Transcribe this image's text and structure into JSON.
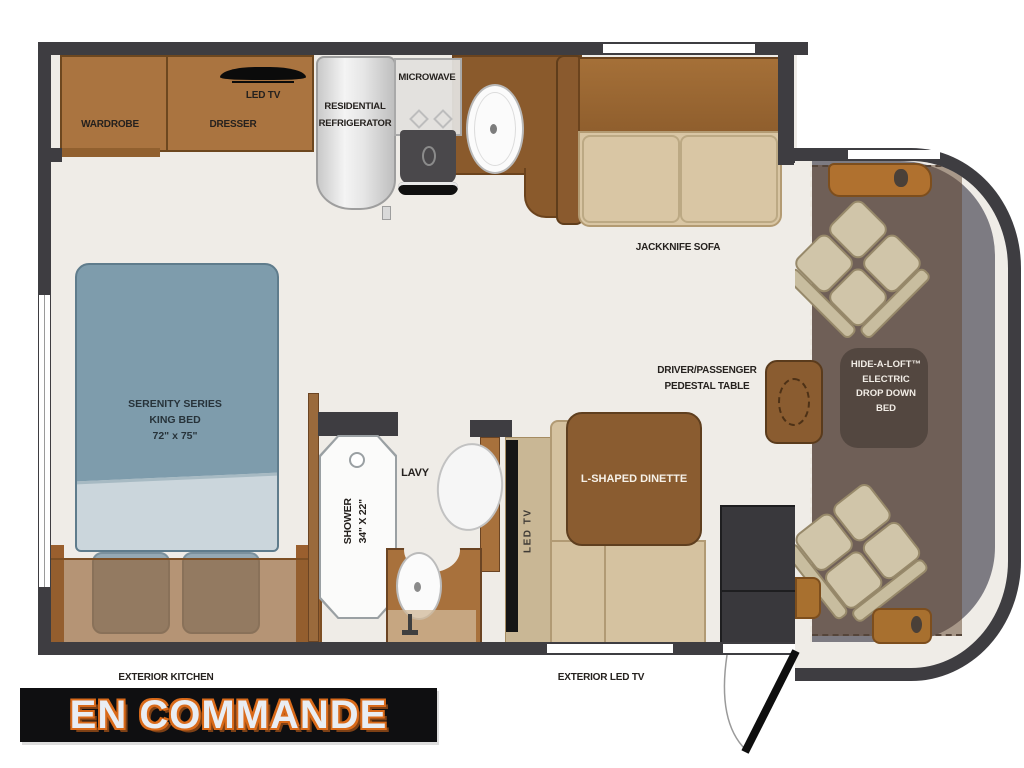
{
  "title_banner": {
    "text": "EN COMMANDE",
    "bg": "#0f0f11",
    "fg": "#e9edf3",
    "outline": "#d96a1a"
  },
  "rooms": {
    "bedroom": {
      "wardrobe_label": "WARDROBE",
      "dresser_label": "DRESSER",
      "tv_label": "LED TV",
      "bed_label_1": "SERENITY SERIES",
      "bed_label_2": "KING BED",
      "bed_label_3": "72\" x 75\""
    },
    "kitchen": {
      "fridge_label_1": "RESIDENTIAL",
      "fridge_label_2": "REFRIGERATOR",
      "microwave_label": "MICROWAVE"
    },
    "living_area": {
      "sofa_label": "JACKKNIFE SOFA",
      "dinette_label": "L-SHAPED DINETTE",
      "dinette_tv_label": "LED TV",
      "pedestal_label_1": "DRIVER/PASSENGER",
      "pedestal_label_2": "PEDESTAL TABLE"
    },
    "bathroom": {
      "shower_label_1": "SHOWER",
      "shower_label_2": "34\" X 22\"",
      "lav_label": "LAVY"
    },
    "cab": {
      "loft_label_1": "HIDE-A-LOFT™",
      "loft_label_2": "ELECTRIC",
      "loft_label_3": "DROP DOWN",
      "loft_label_4": "BED"
    },
    "exterior": {
      "kitchen_label": "EXTERIOR KITCHEN",
      "tv_label": "EXTERIOR LED TV"
    }
  },
  "colors": {
    "wall": "#3e3d41",
    "floor": "#efece7",
    "cabinet_brown": "#aa7440",
    "counter_brown": "#8a5a2c",
    "bed_blue": "#7e9cac",
    "sofa_tan": "#d9c6a4",
    "cab_grey": "#7d7b82",
    "accent_orange": "#b0712f"
  }
}
